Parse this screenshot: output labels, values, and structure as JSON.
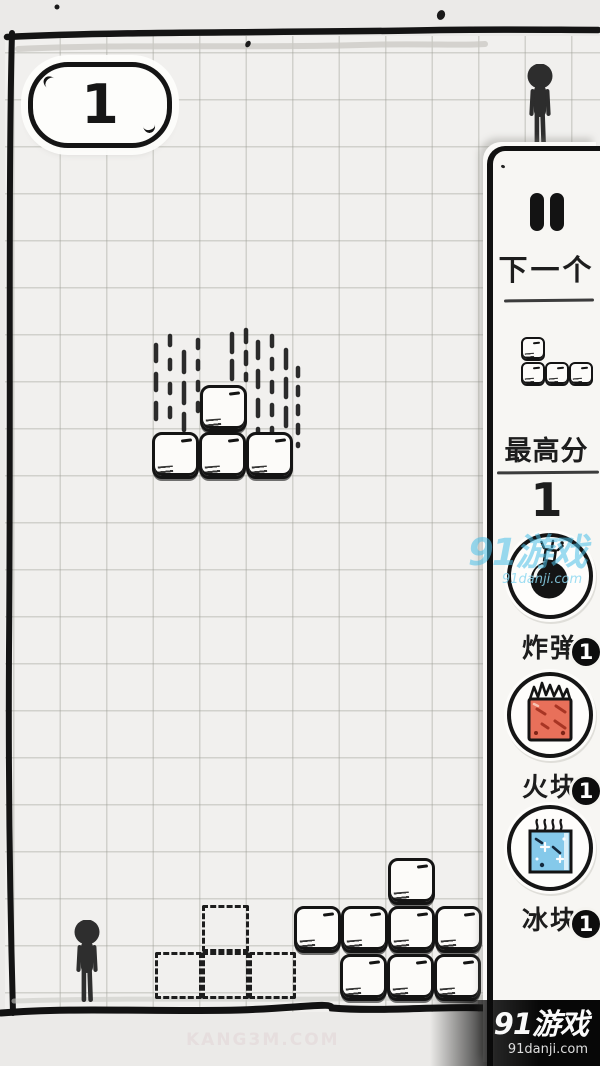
{
  "hud": {
    "score": "1"
  },
  "panel": {
    "pause_icon": "pause-icon",
    "next_label": "下一个",
    "high_score_label": "最高分",
    "high_score_value": "1",
    "items": [
      {
        "id": "bomb",
        "icon": "bomb-icon",
        "label": "炸弹",
        "count": "1"
      },
      {
        "id": "fire",
        "icon": "fire-block-icon",
        "label": "火块",
        "count": "1",
        "color": "#e8705a"
      },
      {
        "id": "ice",
        "icon": "ice-block-icon",
        "label": "冰块",
        "count": "1",
        "color": "#85c9ea"
      }
    ]
  },
  "board": {
    "falling_piece": {
      "shape": "T",
      "cells": [
        [
          200,
          385
        ],
        [
          152,
          432
        ],
        [
          199,
          432
        ],
        [
          246,
          432
        ]
      ]
    },
    "ghost_piece": {
      "shape": "T",
      "cells": [
        [
          202,
          905
        ],
        [
          155,
          952
        ],
        [
          202,
          952
        ],
        [
          249,
          952
        ]
      ]
    },
    "heap_cells": [
      [
        388,
        858
      ],
      [
        294,
        906
      ],
      [
        341,
        906
      ],
      [
        388,
        906
      ],
      [
        435,
        906
      ],
      [
        340,
        954
      ],
      [
        387,
        954
      ],
      [
        434,
        954
      ]
    ],
    "next_piece": {
      "shape": "J",
      "cells": [
        [
          0,
          0
        ],
        [
          0,
          25
        ],
        [
          24,
          25
        ],
        [
          48,
          25
        ]
      ]
    }
  },
  "watermarks": {
    "center": {
      "title": "91游戏",
      "url": "91danji.com"
    },
    "corner": {
      "title": "91游戏",
      "url": "91danji.com"
    },
    "faint": "KANG3M.COM"
  },
  "colors": {
    "ink": "#141414",
    "fire_block": "#e8705a",
    "fire_streak": "#a83524",
    "ice_block": "#85c9ea",
    "watermark_cyan": "#4bc0e8",
    "badge_bg": "#0d0d0d"
  }
}
